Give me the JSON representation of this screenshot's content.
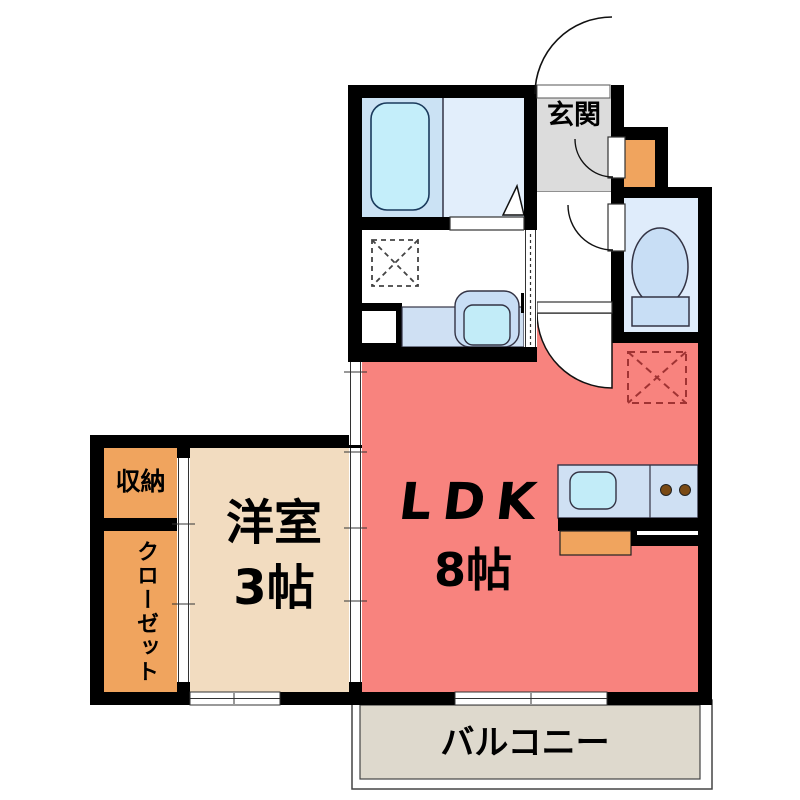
{
  "floorplan": {
    "rooms": {
      "entrance": {
        "label": "玄関"
      },
      "ldk": {
        "label": "LDK",
        "size": "8帖"
      },
      "western_room": {
        "label": "洋室",
        "size": "3帖"
      },
      "storage": {
        "label": "収納"
      },
      "closet": {
        "label": "クローゼット"
      },
      "balcony": {
        "label": "バルコニー"
      }
    },
    "colors": {
      "wall": "#000000",
      "ldk_fill": "#f8837e",
      "western_room_fill": "#f2dcc0",
      "storage_fill": "#f0a45e",
      "entrance_fill": "#dcdcdc",
      "balcony_fill": "#ded9cd",
      "bath_zone_fill": "#cbe2f4",
      "shower_zone_fill": "#e2eefb",
      "bathtub_fill": "#c4eefa",
      "toilet_room_fill": "#dfecfb",
      "fixture_fill": "#c8def5",
      "kitchen_counter_fill": "#cfe0f3",
      "kitchen_sink_fill": "#c2ecf8",
      "burner_fill": "#7a4a14",
      "refrigerator_dash": "#a03333"
    }
  }
}
